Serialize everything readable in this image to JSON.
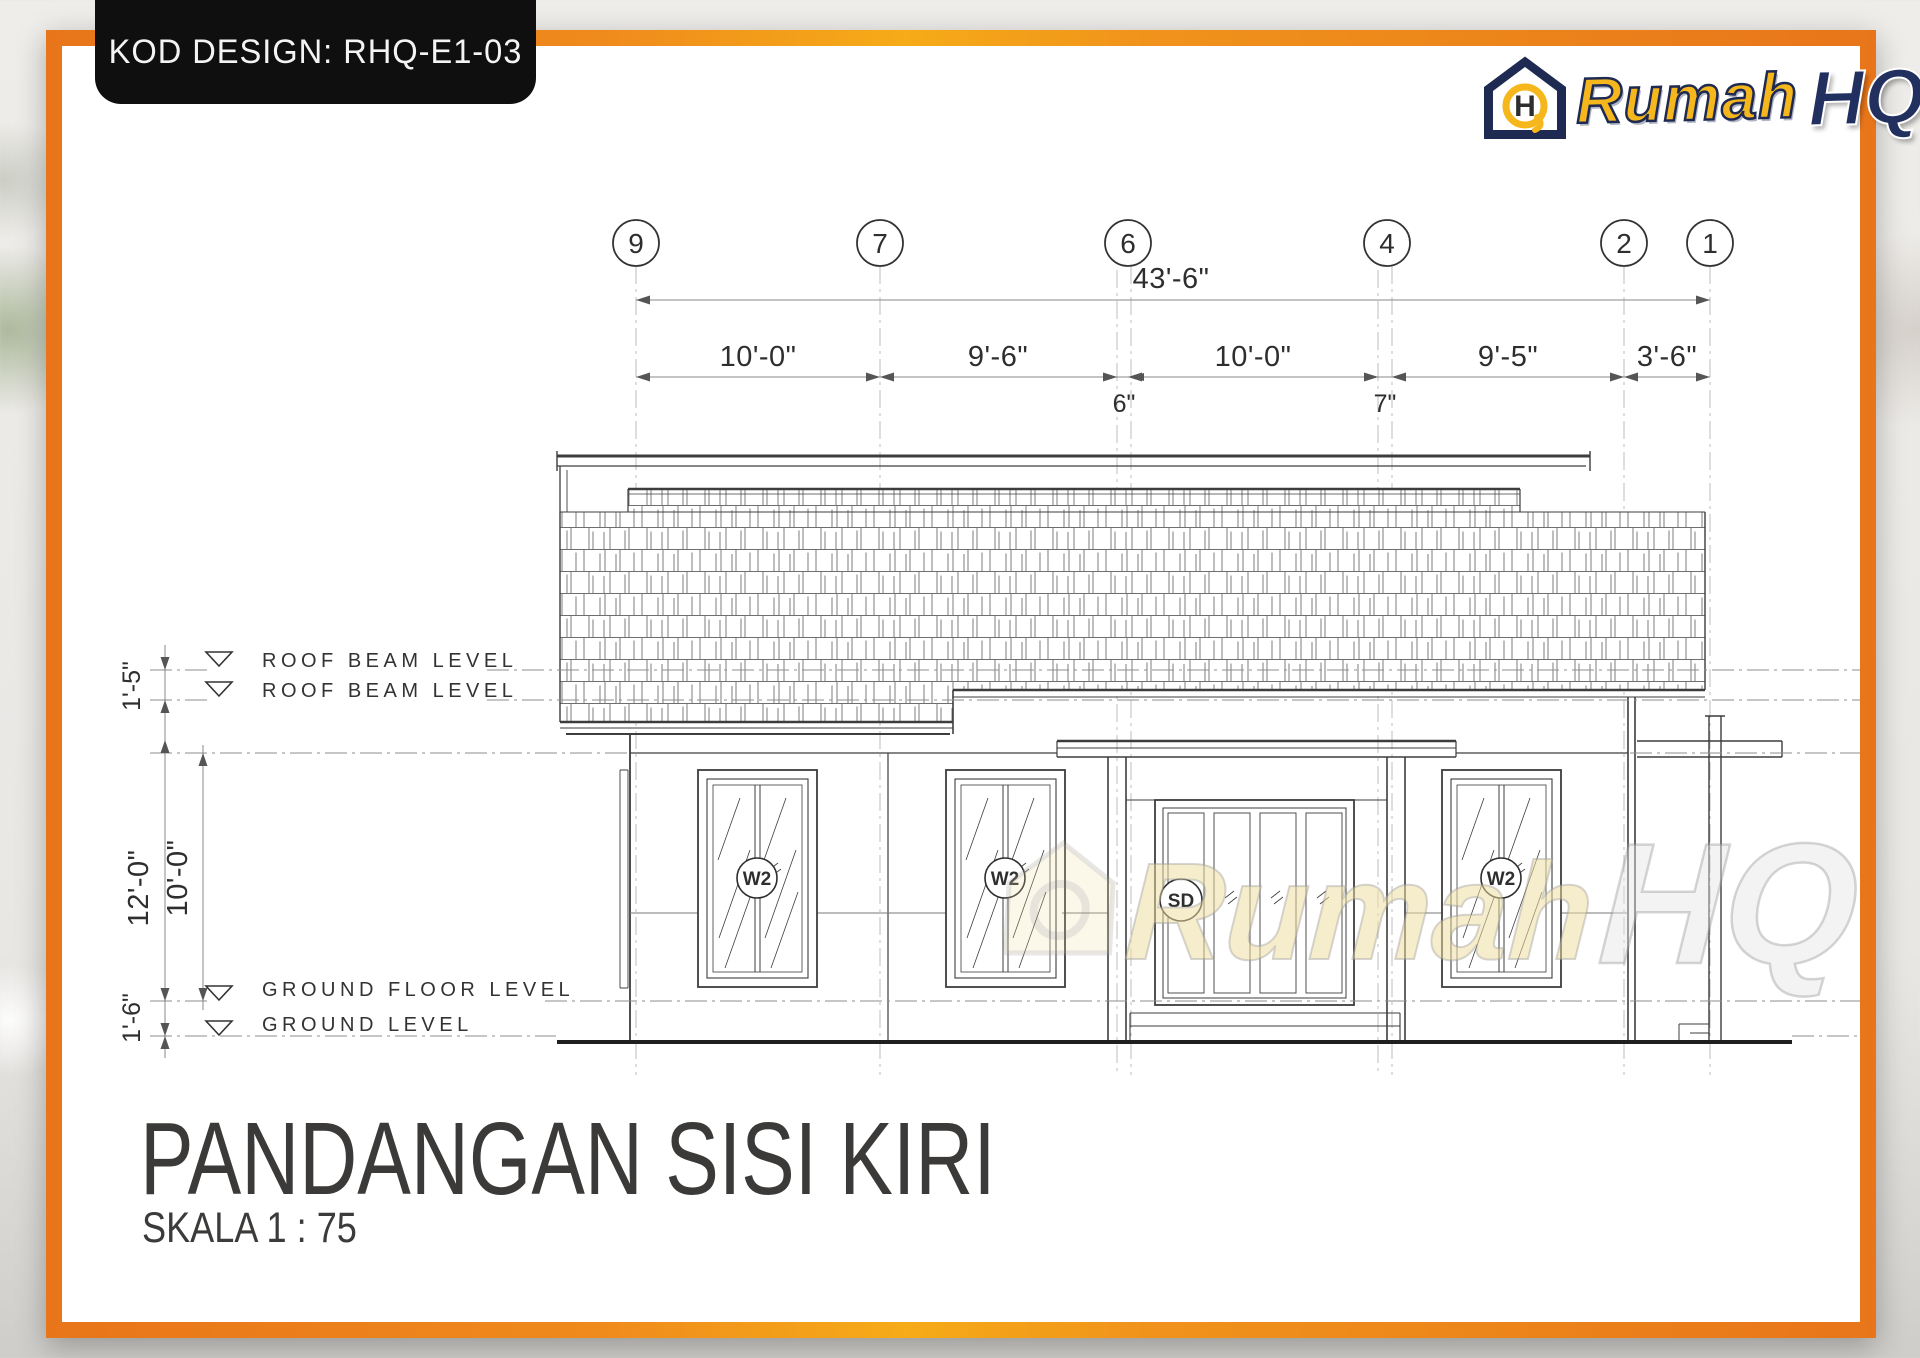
{
  "page": {
    "kod_label": "KOD DESIGN: RHQ-E1-03"
  },
  "logo": {
    "brand_rumah": "Rumah",
    "brand_hq": "HQ"
  },
  "grid_bubbles": [
    "9",
    "7",
    "6",
    "4",
    "2",
    "1"
  ],
  "dimensions": {
    "total": "43'-6\"",
    "segments": [
      "10'-0\"",
      "9'-6\"",
      "10'-0\"",
      "9'-5\"",
      "3'-6\""
    ],
    "small_offsets": [
      "6\"",
      "7\""
    ],
    "vertical": [
      "1'-5\"",
      "12'-0\"",
      "10'-0\"",
      "1'-6\""
    ]
  },
  "levels": [
    {
      "label": "ROOF BEAM LEVEL"
    },
    {
      "label": "ROOF BEAM LEVEL"
    },
    {
      "label": "GROUND FLOOR LEVEL"
    },
    {
      "label": "GROUND LEVEL"
    }
  ],
  "tags": {
    "window": "W2",
    "sliding_door": "SD"
  },
  "title": {
    "main": "PANDANGAN SISI KIRI",
    "scale": "SKALA 1 : 75"
  },
  "watermark": {
    "rumah": "Rumah",
    "hq": "HQ"
  },
  "colors": {
    "frame_orange": "#E8751A",
    "accent_gold": "#F6AB18",
    "logo_yellow": "#F6B71D",
    "logo_navy": "#1E2A52",
    "line_dark": "#3C3C3C",
    "title_gray": "#3B3A39"
  }
}
